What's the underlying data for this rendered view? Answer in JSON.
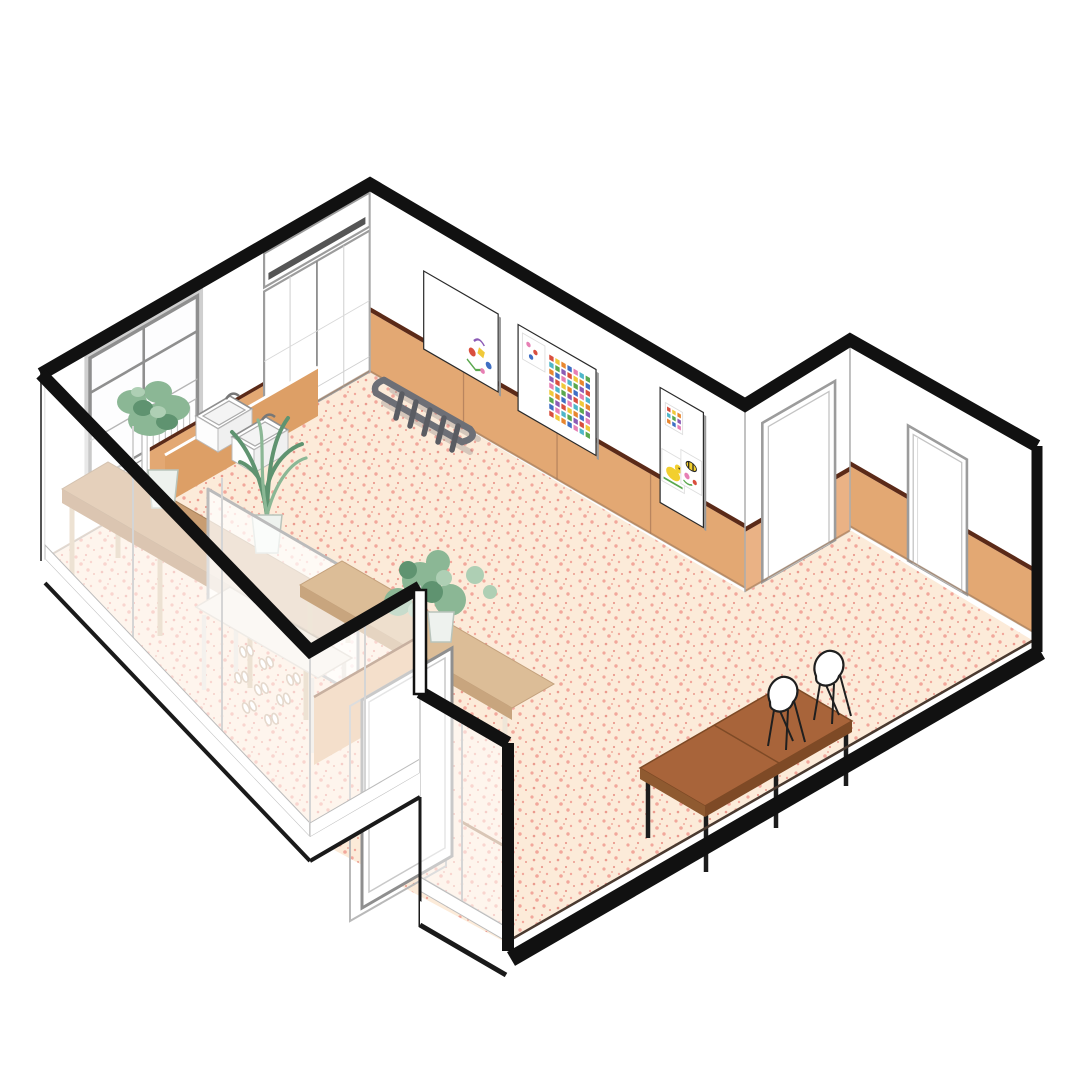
{
  "scene": {
    "description": "Isometric cutaway architectural illustration of a kindergarten classroom",
    "style": "axonometric line drawing with horizontal wall cut"
  },
  "colors": {
    "page_bg": "#ffffff",
    "cut_wall": "#111111",
    "wall_face": "#ffffff",
    "wall_line": "#ababab",
    "floor_base": "#fcebd9",
    "floor_speckle_1": "#f2a79b",
    "floor_speckle_2": "#eb9a8e",
    "floor_edge": "#4a3a30",
    "wainscot": "#e3a873",
    "wainscot_light": "#eab285",
    "wainscot_trim": "#5b2a18",
    "panel_seam": "#b9855f",
    "counter_wood": "#c89d72",
    "counter_edge": "#b4875c",
    "counter_leg": "#d9c2a4",
    "sink_counter": "#dd9f66",
    "sink_white": "#ffffff",
    "table_wood": "#a8643a",
    "table_edge": "#7e4a26",
    "table_light": "#dcbd97",
    "table_light_edge": "#c8a57e",
    "leg_black": "#1c1c1c",
    "ladder_rail": "#6d6f76",
    "ladder_rung": "#5a5c62",
    "plant_green": "#8bb795",
    "plant_green_dark": "#5f9370",
    "plant_green_pale": "#aecfb4",
    "pot_white": "#eef2ee",
    "glass_tint": "rgba(255,255,255,0.52)",
    "glass_frame": "#d5d5d5",
    "door_frame": "#9c9c9c",
    "door_leaf": "#ffffff",
    "transom_slat": "#555555",
    "slab_edge": "#1a1a1a",
    "chair_shell": "#ffffff",
    "chair_line": "#1f1f1f",
    "slipper": "#c9af97",
    "vest_wainscot": "#e9bd92",
    "vest_trim": "#8a5a3a",
    "duck_yellow": "#f2cf2e",
    "duck_beak": "#e8862f",
    "grass_green": "#5aa84e",
    "partition_fill": "rgba(255,255,255,0.72)",
    "white_table": "#f7f1e9",
    "art_palette": [
      "#d94f3e",
      "#3f6fc4",
      "#5aa84e",
      "#f0c93a",
      "#e77fb4",
      "#8b5bb5",
      "#e8862f",
      "#4fb6c9"
    ]
  }
}
